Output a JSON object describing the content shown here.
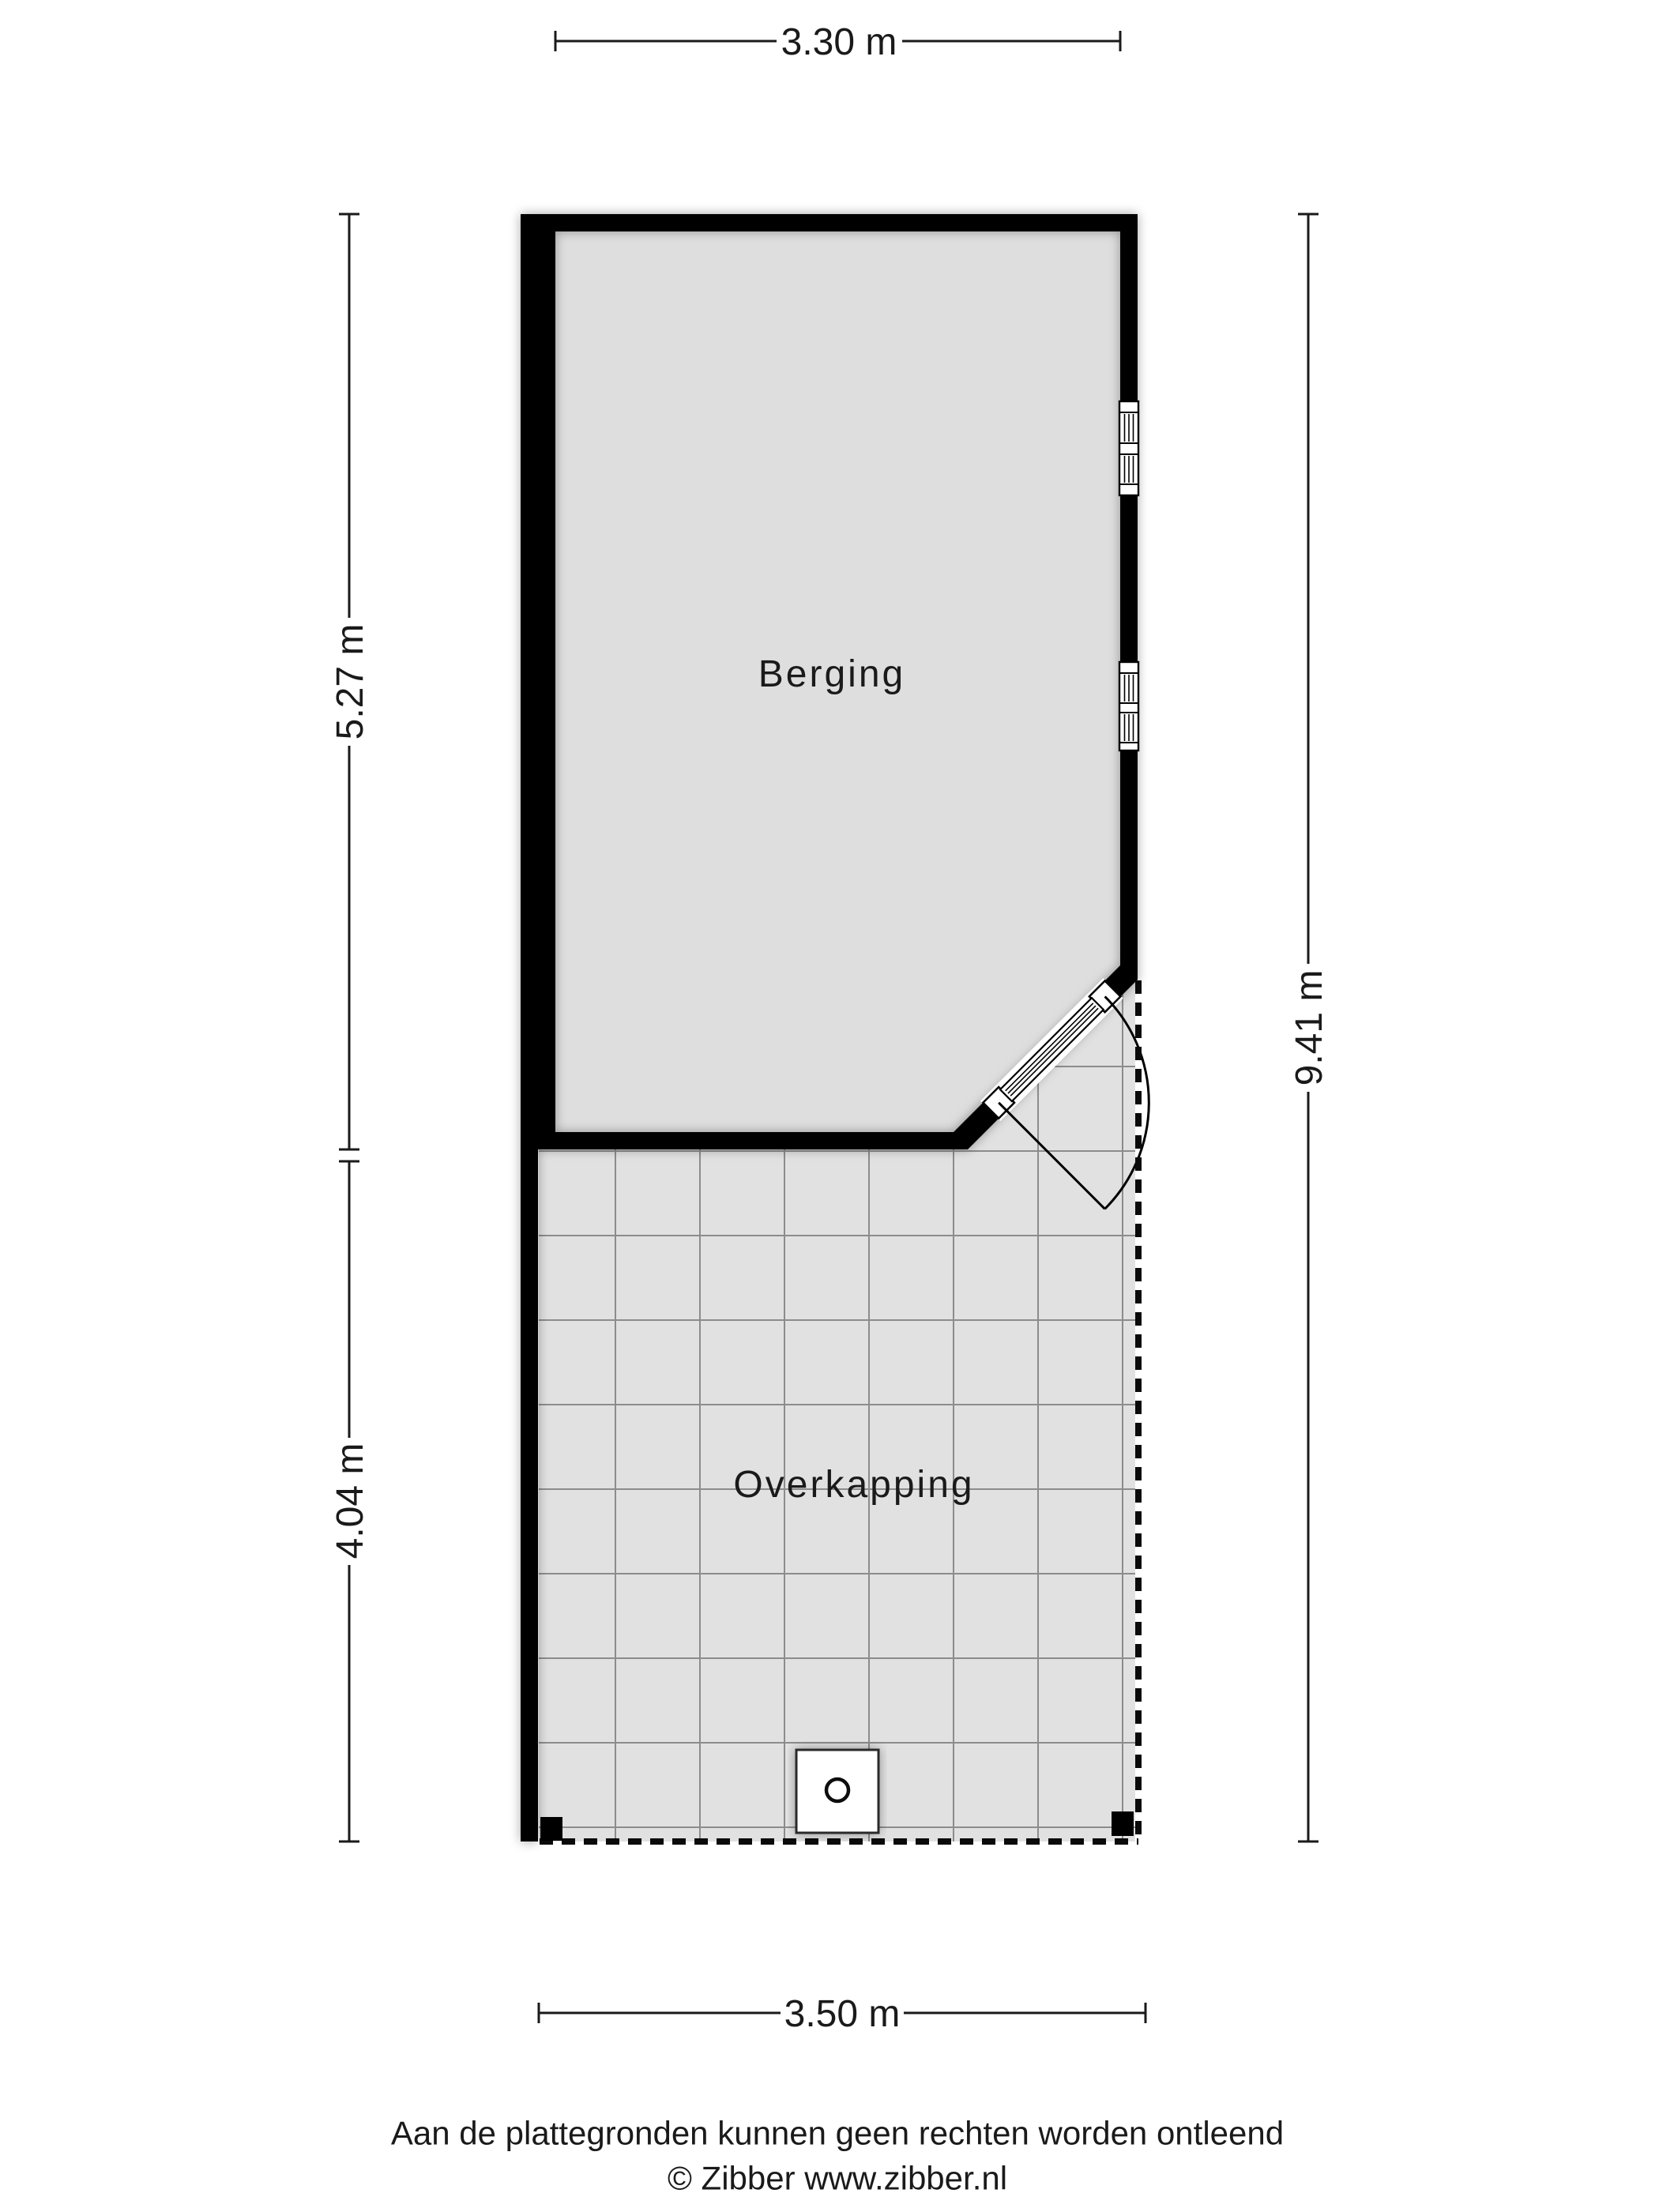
{
  "rooms": {
    "berging": {
      "label": "Berging"
    },
    "overkapping": {
      "label": "Overkapping"
    }
  },
  "dimensions": {
    "top": {
      "label": "3.30 m"
    },
    "left_upper": {
      "label": "5.27 m"
    },
    "left_lower": {
      "label": "4.04 m"
    },
    "right": {
      "label": "9.41 m"
    },
    "bottom": {
      "label": "3.50 m"
    }
  },
  "symbols": {
    "door": "hinged-glass-door",
    "windows": "double-sash-window",
    "appliance": "square-with-circle",
    "posts": "support-post"
  },
  "footer": {
    "disclaimer": "Aan de plattegronden kunnen geen rechten worden ontleend",
    "copyright": "© Zibber www.zibber.nl"
  },
  "colors": {
    "wall": "#000000",
    "berging_floor": "#dedede",
    "tile_floor": "#e1e1e1",
    "grid_line": "#8c8c8c",
    "ink": "#1a1a1a"
  }
}
